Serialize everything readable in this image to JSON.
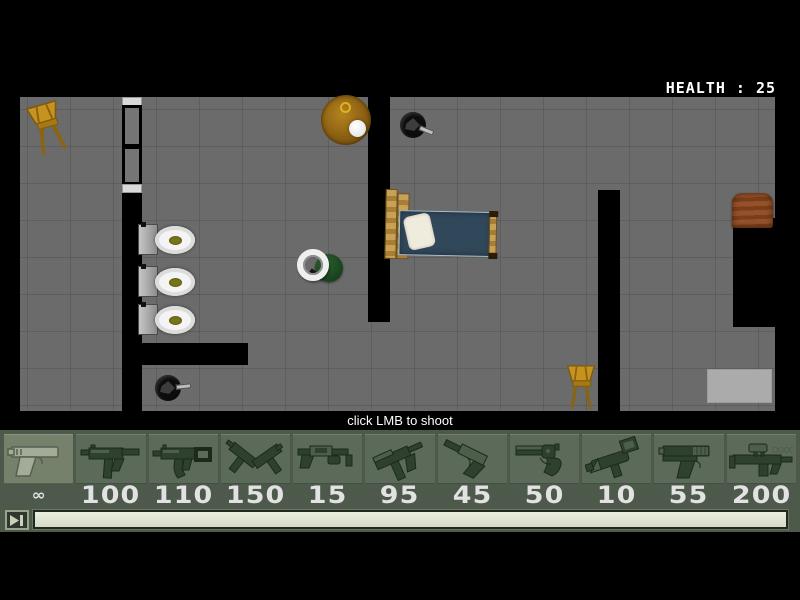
{
  "hud": {
    "health_label": "HEALTH :",
    "health_value": "25"
  },
  "message": "click LMB to shoot",
  "weapons": [
    {
      "name": "pistol",
      "icon": "pistol-icon",
      "ammo": "∞",
      "selected": true
    },
    {
      "name": "uzi",
      "icon": "uzi-icon",
      "ammo": "100",
      "selected": false
    },
    {
      "name": "mp5",
      "icon": "mp5-icon",
      "ammo": "110",
      "selected": false
    },
    {
      "name": "dual-uzis",
      "icon": "dual-uzis-icon",
      "ammo": "150",
      "selected": false
    },
    {
      "name": "shotgun",
      "icon": "shotgun-icon",
      "ammo": "15",
      "selected": false
    },
    {
      "name": "tec9",
      "icon": "tec9-icon",
      "ammo": "95",
      "selected": false
    },
    {
      "name": "silenced-pistol",
      "icon": "silenced-pistol-icon",
      "ammo": "45",
      "selected": false
    },
    {
      "name": "revolver",
      "icon": "revolver-icon",
      "ammo": "50",
      "selected": false
    },
    {
      "name": "launcher",
      "icon": "launcher-icon",
      "ammo": "10",
      "selected": false
    },
    {
      "name": "combat-pistol",
      "icon": "combat-pistol-icon",
      "ammo": "55",
      "selected": false
    },
    {
      "name": "scoped-rifle",
      "icon": "scoped-rifle-icon",
      "ammo": "200",
      "selected": false
    }
  ],
  "scrubber": {
    "progress_percent": 100
  },
  "colors": {
    "floor": "#6b6b6b",
    "wall": "#000000",
    "bar_bg": "#4d594b",
    "slot_bg": "#5c6a5a",
    "slot_selected_bg": "#75816b",
    "ammo_text": "#e2e2e2",
    "health_text": "#ffffff",
    "player_green": "#1d4a22",
    "mattress_blue": "#31475a",
    "chair_gold": "#c8921e",
    "table_amber": "#9c6a12",
    "crate_brown": "#8a4a24"
  }
}
